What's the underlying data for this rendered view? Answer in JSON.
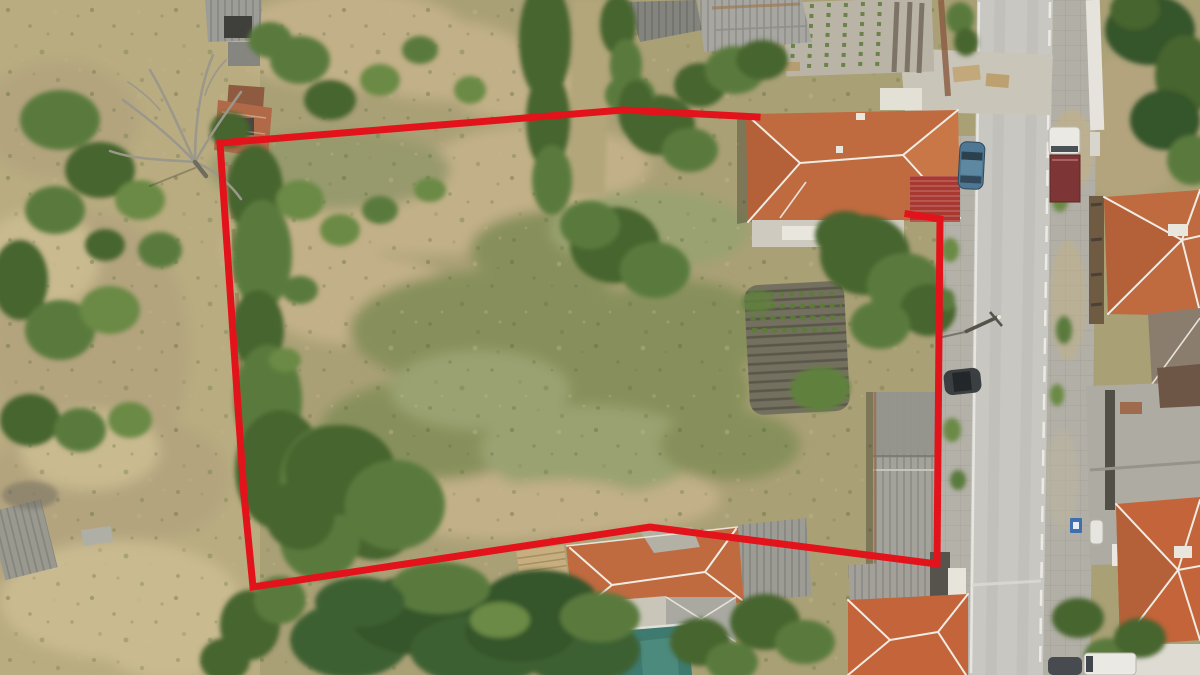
{
  "image": {
    "kind": "aerial-drone-photograph",
    "subject": "rural land plot outlined in red next to a village street with tiled-roof houses"
  },
  "boundary": {
    "color": "#e3131b",
    "stroke_width": 7,
    "points": "908,214 940,219 937,564 650,527 253,587 244,495 220,143 623,110 757,117"
  },
  "palette": {
    "field_tan": "#aaa076",
    "dry_grass": "#bcae82",
    "road_gray": "#c8c7c2",
    "sidewalk_gray": "#b4b1a8",
    "roof_orange": "#c06a40",
    "roof_orange_bright": "#c4643a",
    "ridge_white": "#efece3",
    "garage_red": "#a83931",
    "metal_gray": "#a3a29b",
    "pool_teal": "#3e7a6f",
    "soil_brown": "#74705f",
    "leafy_green": "#3e6030",
    "car_blue": "#4d7793",
    "truck_box_maroon": "#7e3535",
    "car_dark": "#3c3f41",
    "van_white": "#eae9e3",
    "parking_sign_blue": "#3f6fae"
  }
}
